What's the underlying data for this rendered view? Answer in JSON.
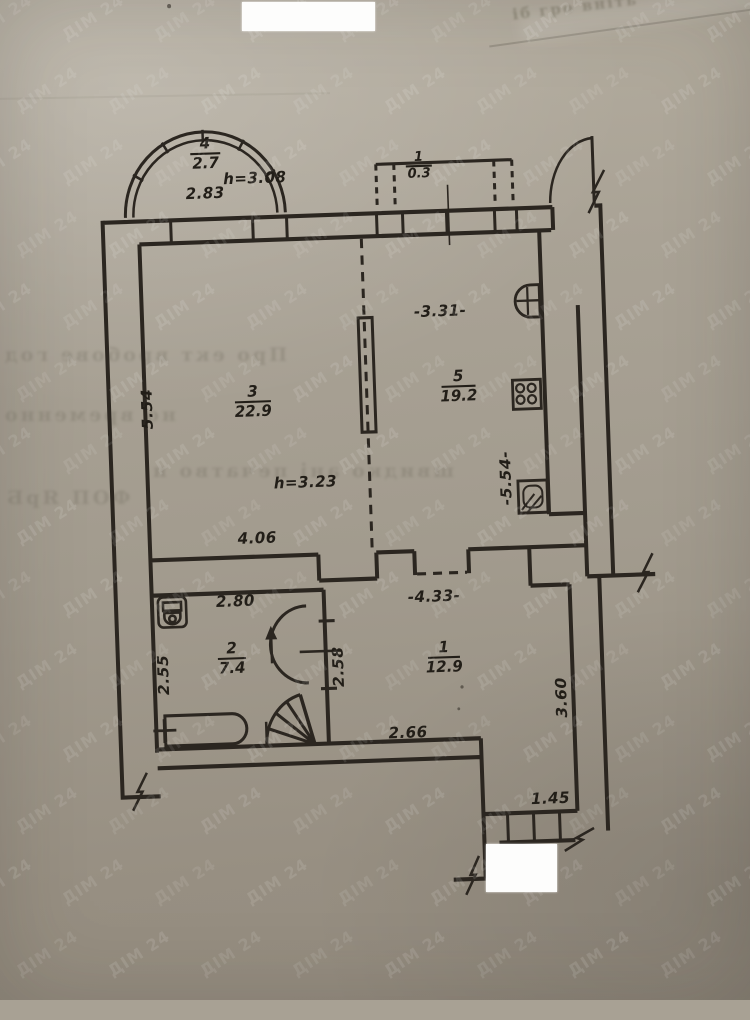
{
  "watermark": {
    "text": "ДІМ 24"
  },
  "labels": {
    "bay_num": "4",
    "bay_area": "2.7",
    "bay_h": "h=3.08",
    "bay_w": "2.83",
    "balc_num": "1",
    "balc_area": "0.3",
    "r3_num": "3",
    "r3_area": "22.9",
    "r3_h": "h=3.23",
    "r3_w": "4.06",
    "r3_len": "5.54",
    "r5_num": "5",
    "r5_area": "19.2",
    "r5_w": "-3.31-",
    "r5_len": "-5.54-",
    "r2_num": "2",
    "r2_area": "7.4",
    "r2_w": "2.80",
    "r2_len": "2.55",
    "stair_dim": "2.58",
    "r1_num": "1",
    "r1_area": "12.9",
    "r1_w": "-4.33-",
    "r1_w2": "2.66",
    "r1_len": "3.60",
    "porch_w": "1.45"
  },
  "bleed": {
    "l1": "Про ект вробове год",
    "l2": "но временно",
    "l3": "швидко ані печатво н",
    "l4": "ФОП ЯрБ"
  },
  "edge_note": "іб гро вніть"
}
